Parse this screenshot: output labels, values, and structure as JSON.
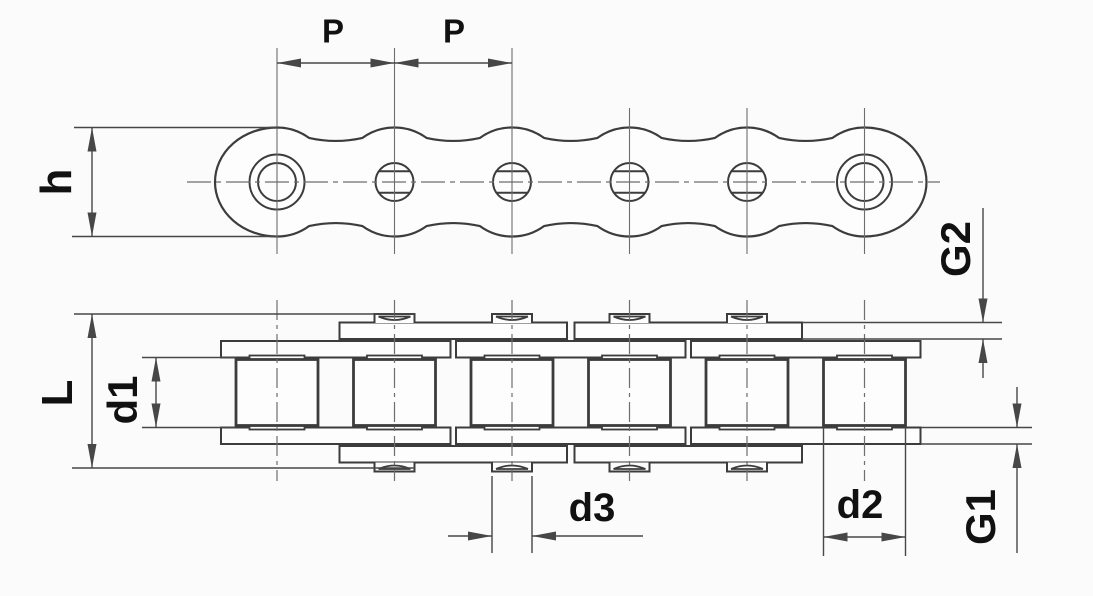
{
  "drawing": {
    "labels": {
      "P1": "P",
      "P2": "P",
      "h": "h",
      "L": "L",
      "d1": "d1",
      "d3": "d3",
      "d2": "d2",
      "G1": "G1",
      "G2": "G2"
    },
    "colors": {
      "background": "#fbfbfb",
      "line": "#3c3c3c",
      "dimension": "#474747",
      "centerline": "#6e6e6e",
      "label": "#111111"
    }
  }
}
